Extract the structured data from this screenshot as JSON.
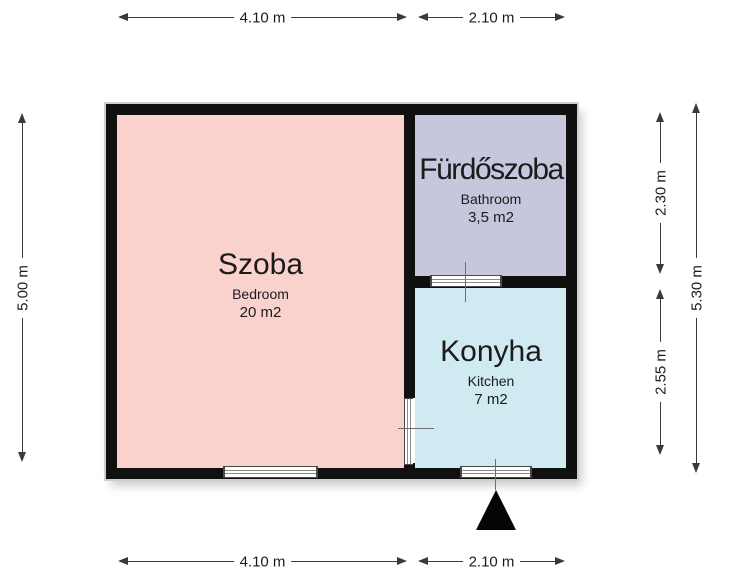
{
  "plan": {
    "rooms": {
      "bedroom": {
        "name": "Szoba",
        "subtitle": "Bedroom",
        "area": "20 m2",
        "fill": "#f9d2cd"
      },
      "bathroom": {
        "name": "Fürdőszoba",
        "subtitle": "Bathroom",
        "area": "3,5 m2",
        "fill": "#c6c6dc"
      },
      "kitchen": {
        "name": "Konyha",
        "subtitle": "Kitchen",
        "area": "7 m2",
        "fill": "#cfeaf0"
      }
    },
    "dims": {
      "top_left": "4.10 m",
      "top_right": "2.10 m",
      "bottom_left": "4.10 m",
      "bottom_right": "2.10 m",
      "left": "5.00 m",
      "right_bathroom": "2.30 m",
      "right_kitchen": "2.55 m",
      "right_total": "5.30 m"
    },
    "colors": {
      "wall": "#101010",
      "dimension_line": "#3a3a3a",
      "bedroom_fill": "#f9d2cd",
      "bathroom_fill": "#c6c6dc",
      "kitchen_fill": "#cfeaf0"
    },
    "icons": {
      "entrance_arrow": "filled-triangle-up"
    }
  }
}
